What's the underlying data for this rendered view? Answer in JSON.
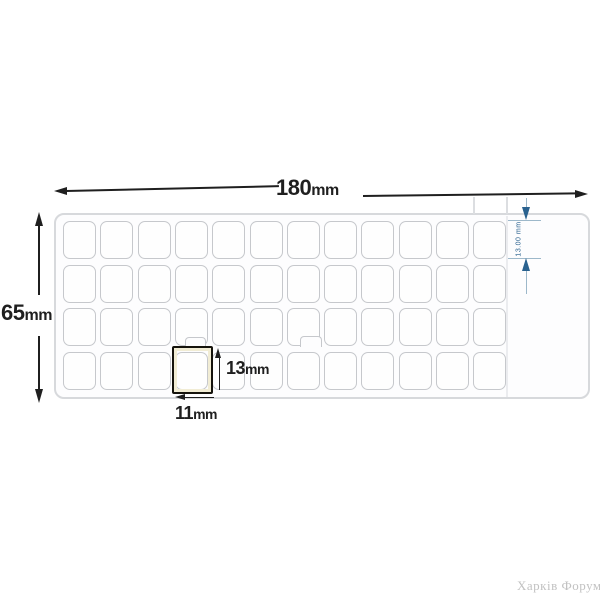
{
  "diagram": {
    "type": "keyboard-sticker-sheet-dimension-drawing",
    "sheet": {
      "rows": 4,
      "cols": 12
    },
    "dimensions": {
      "width": {
        "value": "180",
        "unit": "mm"
      },
      "height": {
        "value": "65",
        "unit": "mm"
      },
      "cell_height": {
        "value": "13",
        "unit": "mm"
      },
      "cell_width": {
        "value": "11",
        "unit": "mm"
      },
      "row_height_note": "13.00 mm"
    },
    "watermark": "Харків Форум",
    "colors": {
      "ink": "#1f1f1f",
      "cell-border": "#c6c8cc",
      "sheet-border": "#d7d9dc",
      "blue": "#2a628f",
      "blue-light": "#9db8ca",
      "highlight": "#15130c",
      "highlight-glow": "#f1ecd4",
      "ghost": "#dcdee1",
      "watermark": "#c2c2c2"
    }
  }
}
